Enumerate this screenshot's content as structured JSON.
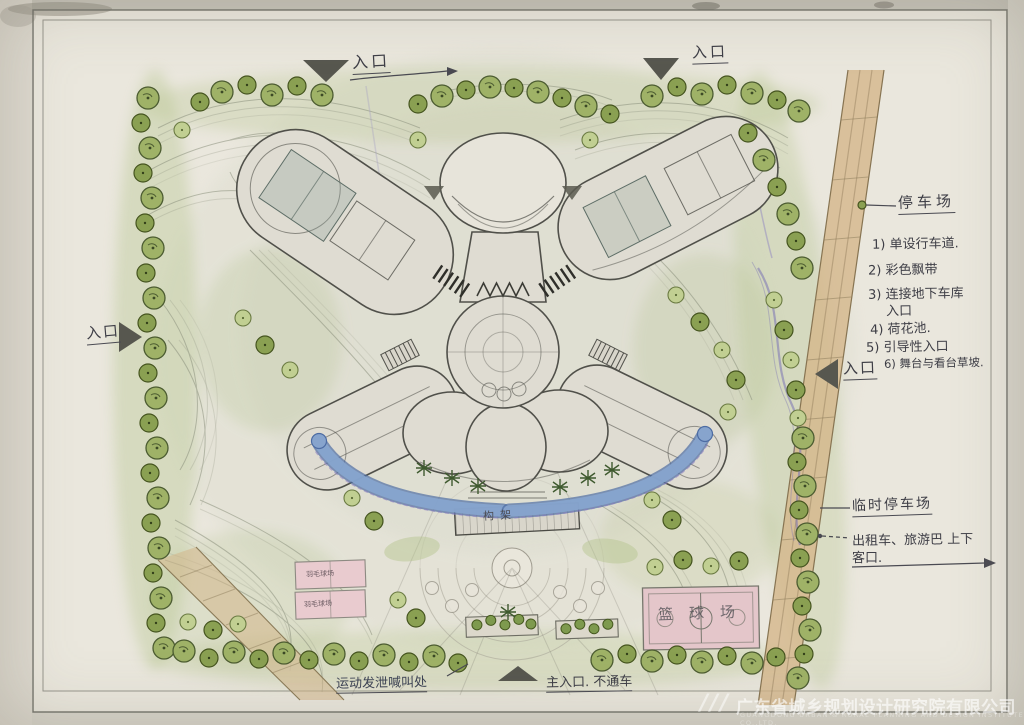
{
  "annotations": {
    "entrance_top_left": "入口",
    "entrance_top_right": "入口",
    "entrance_left": "入口",
    "entrance_right": "入口",
    "parking": "停车场",
    "notes": [
      "1) 单设行车道.",
      "2) 彩色飘带",
      "3) 连接地下车库",
      "入口",
      "4) 荷花池.",
      "5) 引导性入口",
      "6) 舞台与看台草坡."
    ],
    "temp_parking": "临时停车场",
    "taxi_line1": "出租车、旅游巴 上下",
    "taxi_line2": "客口.",
    "shout_area": "运动发泄喊叫处",
    "main_entrance": "主入口. 不通车"
  },
  "labels": {
    "pergola": "构架",
    "badminton_1": "羽毛球场",
    "badminton_2": "羽毛球场",
    "basketball": "篮球场"
  },
  "watermark": {
    "logo": "///",
    "company_cn": "广东省城乡规划设计研究院有限公司",
    "company_en": "GUANGDONG URBAN & RURAL PLANNING AND DESIGN INSTITUTE CO.,LTD."
  },
  "colors": {
    "paper": "#eae7dd",
    "pencil": "#50504a",
    "water": "#87a4cd",
    "tree": "#9fb267",
    "road_tan": "#d4b68b",
    "court_pink": "#e9cbcf"
  }
}
